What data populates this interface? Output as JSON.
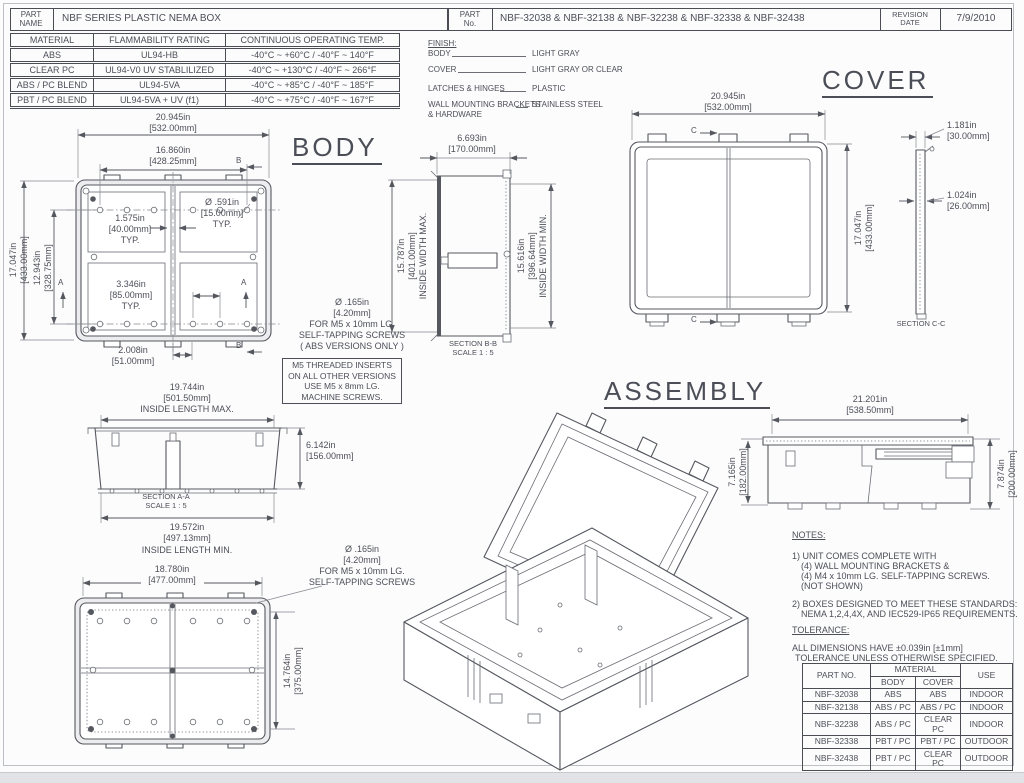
{
  "header": {
    "part_label_1": "PART",
    "part_label_2": "NAME",
    "part_name": "NBF SERIES PLASTIC NEMA BOX",
    "no_label_1": "PART",
    "no_label_2": "No.",
    "part_no": "NBF-32038 & NBF-32138 & NBF-32238 & NBF-32338 & NBF-32438",
    "rev_label_1": "REVISION",
    "rev_label_2": "DATE",
    "revision_date": "7/9/2010"
  },
  "materials_table": {
    "headers": [
      "MATERIAL",
      "FLAMMABILITY RATING",
      "CONTINUOUS OPERATING TEMP."
    ],
    "rows": [
      [
        "ABS",
        "UL94-HB",
        "-40°C ~ +60°C / -40°F ~ 140°F"
      ],
      [
        "CLEAR PC",
        "UL94-V0  UV STABLILIZED",
        "-40°C ~ +130°C / -40°F ~ 266°F"
      ],
      [
        "ABS / PC BLEND",
        "UL94-5VA",
        "-40°C ~ +85°C / -40°F ~ 185°F"
      ],
      [
        "PBT / PC BLEND",
        "UL94-5VA + UV (f1)",
        "-40°C ~ +75°C / -40°F ~ 167°F"
      ]
    ]
  },
  "finish": {
    "title": "FINISH:",
    "body_label": "BODY",
    "body_value": "LIGHT GRAY",
    "cover_label": "COVER",
    "cover_value": "LIGHT GRAY OR CLEAR",
    "latches_label": "LATCHES & HINGES",
    "latches_value": "PLASTIC",
    "brackets_label": "WALL MOUNTING BRACKETS",
    "brackets_label2": "& HARDWARE",
    "brackets_value": "STAINLESS STEEL"
  },
  "titles": {
    "body": "BODY",
    "cover": "COVER",
    "assembly": "ASSEMBLY"
  },
  "body_view": {
    "dim_width_in": "20.945in",
    "dim_width_mm": "[532.00mm]",
    "dim_width2_in": "16.860in",
    "dim_width2_mm": "[428.25mm]",
    "dim_height_in": "17.047in",
    "dim_height_mm": "[433.00mm]",
    "dim_height2_in": "12.943in",
    "dim_height2_mm": "[328.75mm]",
    "dim_pitch_in": "1.575in",
    "dim_pitch_mm": "[40.00mm]",
    "dim_pitch_typ": "TYP.",
    "dim_hole_in": "Ø .591in",
    "dim_hole_mm": "[15.00mm]",
    "dim_hole_typ": "TYP.",
    "dim_span_in": "3.346in",
    "dim_span_mm": "[85.00mm]",
    "dim_span_typ": "TYP.",
    "dim_offset_in": "2.008in",
    "dim_offset_mm": "[51.00mm]",
    "marker_a": "A",
    "marker_b": "B"
  },
  "screw_note": {
    "line1": "Ø .165in",
    "line2": "[4.20mm]",
    "line3": "FOR M5 x 10mm LG.",
    "line4": "SELF-TAPPING SCREWS",
    "line5": "( ABS VERSIONS ONLY )",
    "boxed1": "M5 THREADED INSERTS",
    "boxed2": "ON ALL OTHER VERSIONS",
    "boxed3": "USE M5 x 8mm LG.",
    "boxed4": "MACHINE SCREWS."
  },
  "section_bb": {
    "dim_depth_in": "6.693in",
    "dim_depth_mm": "[170.00mm]",
    "max_in": "15.787in",
    "max_mm": "[401.00mm]",
    "max_label": "INSIDE WIDTH MAX.",
    "min_in": "15.616in",
    "min_mm": "[396.64mm]",
    "min_label": "INSIDE WIDTH MIN.",
    "caption1": "SECTION B-B",
    "caption2": "SCALE 1 : 5"
  },
  "cover_view": {
    "dim_width_in": "20.945in",
    "dim_width_mm": "[532.00mm]",
    "dim_height_in": "17.047in",
    "dim_height_mm": "[433.00mm]",
    "marker_c": "C"
  },
  "section_cc": {
    "dim1_in": "1.181in",
    "dim1_mm": "[30.00mm]",
    "dim2_in": "1.024in",
    "dim2_mm": "[26.00mm]",
    "caption": "SECTION C-C"
  },
  "section_aa": {
    "max_in": "19.744in",
    "max_mm": "[501.50mm]",
    "max_label": "INSIDE LENGTH MAX.",
    "depth_in": "6.142in",
    "depth_mm": "[156.00mm]",
    "caption1": "SECTION A-A",
    "caption2": "SCALE 1 : 5",
    "min_in": "19.572in",
    "min_mm": "[497.13mm]",
    "min_label": "INSIDE LENGTH MIN."
  },
  "bottom_view": {
    "dim_width_in": "18.780in",
    "dim_width_mm": "[477.00mm]",
    "dim_height_in": "14.764in",
    "dim_height_mm": "[375.00mm]",
    "callout1": "Ø .165in",
    "callout2": "[4.20mm]",
    "callout3": "FOR M5 x 10mm LG.",
    "callout4": "SELF-TAPPING SCREWS"
  },
  "assembly_view": {
    "dim_width_in": "21.201in",
    "dim_width_mm": "[538.50mm]",
    "dim_body_in": "7.165in",
    "dim_body_mm": "[182.00mm]",
    "dim_total_in": "7.874in",
    "dim_total_mm": "[200.00mm]"
  },
  "notes": {
    "title": "NOTES:",
    "n1_l1": "1) UNIT COMES COMPLETE WITH",
    "n1_l2": "(4) WALL MOUNTING BRACKETS &",
    "n1_l3": "(4) M4 x 10mm LG. SELF-TAPPING SCREWS.",
    "n1_l4": "(NOT SHOWN)",
    "n2_l1": "2) BOXES DESIGNED TO MEET THESE STANDARDS:",
    "n2_l2": "NEMA 1,2,4,4X, AND IEC529-IP65 REQUIREMENTS."
  },
  "tolerance": {
    "title": "TOLERANCE:",
    "l1": "ALL DIMENSIONS HAVE ±0.039in [±1mm]",
    "l2": "TOLERANCE UNLESS OTHERWISE SPECIFIED."
  },
  "parts_table": {
    "col_part": "PART NO.",
    "col_material": "MATERIAL",
    "col_body": "BODY",
    "col_cover": "COVER",
    "col_use": "USE",
    "rows": [
      {
        "part": "NBF-32038",
        "body": "ABS",
        "cover": "ABS",
        "use": "INDOOR"
      },
      {
        "part": "NBF-32138",
        "body": "ABS / PC",
        "cover": "ABS / PC",
        "use": "INDOOR"
      },
      {
        "part": "NBF-32238",
        "body": "ABS / PC",
        "cover": "CLEAR PC",
        "use": "INDOOR"
      },
      {
        "part": "NBF-32338",
        "body": "PBT / PC",
        "cover": "PBT / PC",
        "use": "OUTDOOR"
      },
      {
        "part": "NBF-32438",
        "body": "PBT / PC",
        "cover": "CLEAR PC",
        "use": "OUTDOOR"
      }
    ]
  },
  "colors": {
    "line": "#54575e",
    "text": "#4d4f58",
    "fill_light": "#ededef"
  }
}
